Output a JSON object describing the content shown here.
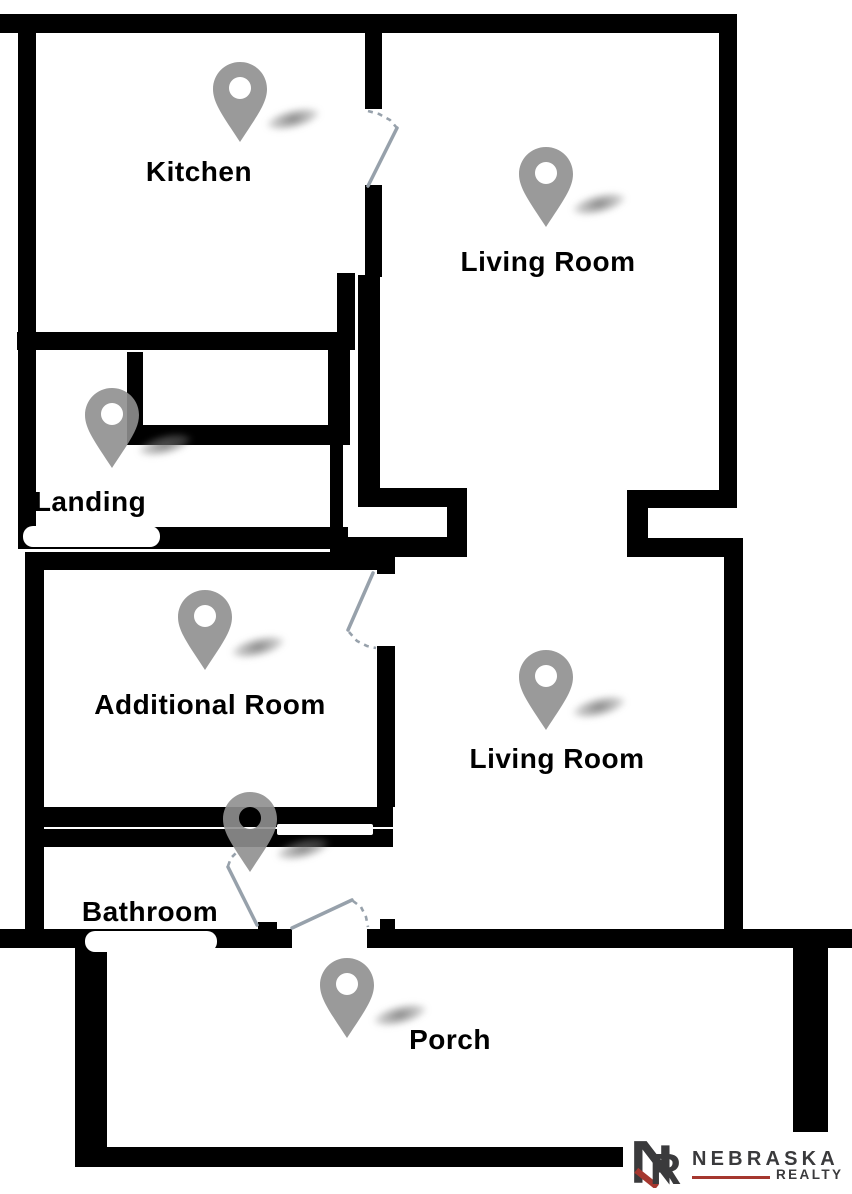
{
  "canvas": {
    "width": 852,
    "height": 1194,
    "background": "#ffffff"
  },
  "colors": {
    "wall": "#000000",
    "pin": "#8f8f8f",
    "pin_shadow": "#6e6e6e",
    "door": "#97a1ab",
    "label": "#000000",
    "opening": "#ffffff",
    "logo_dark": "#3a3a3c",
    "logo_red": "#a5372f"
  },
  "rooms": [
    {
      "label": "Kitchen",
      "label_cx": 199,
      "label_cy": 172,
      "pin_x": 213,
      "pin_y": 62
    },
    {
      "label": "Living Room",
      "label_cx": 548,
      "label_cy": 262,
      "pin_x": 519,
      "pin_y": 147
    },
    {
      "label": "Landing",
      "label_cx": 90,
      "label_cy": 502,
      "pin_x": 85,
      "pin_y": 388
    },
    {
      "label": "Additional Room",
      "label_cx": 210,
      "label_cy": 705,
      "pin_x": 178,
      "pin_y": 590
    },
    {
      "label": "Living Room",
      "label_cx": 557,
      "label_cy": 759,
      "pin_x": 519,
      "pin_y": 650
    },
    {
      "label": "Bathroom",
      "label_cx": 150,
      "label_cy": 912,
      "pin_x": 223,
      "pin_y": 792
    },
    {
      "label": "Porch",
      "label_cx": 450,
      "label_cy": 1040,
      "pin_x": 320,
      "pin_y": 958
    }
  ],
  "walls": [
    [
      0,
      14,
      737,
      19
    ],
    [
      18,
      33,
      18,
      516
    ],
    [
      17,
      332,
      338,
      18
    ],
    [
      365,
      33,
      17,
      76
    ],
    [
      365,
      185,
      17,
      92
    ],
    [
      358,
      275,
      22,
      232
    ],
    [
      337,
      273,
      18,
      77
    ],
    [
      328,
      340,
      22,
      105
    ],
    [
      330,
      428,
      13,
      132
    ],
    [
      127,
      352,
      16,
      77
    ],
    [
      127,
      425,
      221,
      20
    ],
    [
      22,
      527,
      326,
      22
    ],
    [
      377,
      488,
      90,
      19
    ],
    [
      447,
      488,
      20,
      67
    ],
    [
      343,
      537,
      124,
      20
    ],
    [
      719,
      33,
      18,
      475
    ],
    [
      627,
      490,
      110,
      18
    ],
    [
      627,
      490,
      21,
      67
    ],
    [
      627,
      538,
      116,
      19
    ],
    [
      724,
      552,
      19,
      383
    ],
    [
      36,
      552,
      357,
      18
    ],
    [
      25,
      552,
      19,
      396
    ],
    [
      377,
      552,
      18,
      22
    ],
    [
      377,
      646,
      18,
      161
    ],
    [
      25,
      807,
      368,
      20
    ],
    [
      42,
      829,
      351,
      18
    ],
    [
      0,
      929,
      292,
      19
    ],
    [
      258,
      922,
      19,
      26
    ],
    [
      367,
      929,
      485,
      19
    ],
    [
      380,
      919,
      15,
      12
    ],
    [
      75,
      948,
      32,
      219
    ],
    [
      75,
      1147,
      548,
      20
    ],
    [
      793,
      947,
      35,
      185
    ]
  ],
  "openings": [
    {
      "x": 23,
      "y": 526,
      "w": 137,
      "h": 21,
      "r": 10
    },
    {
      "x": 85,
      "y": 931,
      "w": 132,
      "h": 21,
      "r": 10
    },
    {
      "x": 277,
      "y": 824,
      "w": 96,
      "h": 11,
      "r": 2
    }
  ],
  "doors": [
    {
      "name": "kitchen-door",
      "leaf": [
        368,
        186,
        397,
        128
      ],
      "swing": [
        [
          368,
          111
        ],
        [
          379,
          114
        ],
        [
          390,
          120
        ],
        [
          397,
          128
        ]
      ]
    },
    {
      "name": "additional-room-door",
      "leaf": [
        373,
        573,
        348,
        630
      ],
      "swing": [
        [
          349,
          632
        ],
        [
          357,
          641
        ],
        [
          367,
          646
        ],
        [
          376,
          648
        ]
      ]
    },
    {
      "name": "bathroom-door",
      "leaf": [
        257,
        925,
        228,
        867
      ],
      "swing": [
        [
          228,
          866
        ],
        [
          231,
          858
        ],
        [
          237,
          852
        ]
      ]
    },
    {
      "name": "porch-door",
      "leaf": [
        292,
        928,
        352,
        900
      ],
      "swing": [
        [
          353,
          901
        ],
        [
          361,
          907
        ],
        [
          366,
          917
        ],
        [
          368,
          927
        ]
      ]
    }
  ],
  "pin": {
    "width": 54,
    "height": 80,
    "shadow": {
      "dx": 44,
      "dy": 44,
      "w": 72,
      "h": 26
    }
  },
  "logo": {
    "brand": "NEBRASKA",
    "division": "REALTY",
    "monogram_n": "N",
    "monogram_r": "R"
  }
}
